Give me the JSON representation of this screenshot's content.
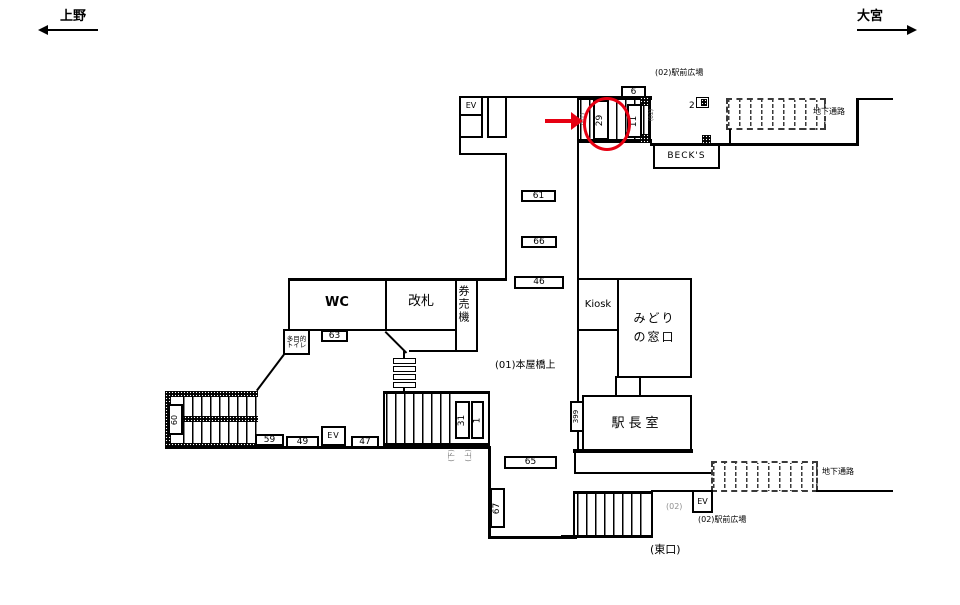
{
  "colors": {
    "line": "#000000",
    "highlight": "#e60012",
    "muted": "#8f8f8f"
  },
  "directions": {
    "left": "上野",
    "right": "大宮"
  },
  "rooms": {
    "ev": "EV",
    "wc": "WC",
    "kaisatsu": "改札",
    "kenbaiki": "券売機",
    "tamokuteki": [
      "多目的",
      "トイレ"
    ],
    "kiosk": "Kiosk",
    "midori": [
      "みどり",
      "の窓口"
    ],
    "ekicho": "駅長室",
    "becks": "BECK'S"
  },
  "labels": {
    "plaza_top": "(02)駅前広場",
    "plaza_bottom": "(02)駅前広場",
    "underpass_top": "地下通路",
    "underpass_bottom": "地下通路",
    "honyabashi": "(01)本屋橋上",
    "east_exit": "(東口)",
    "small_01": "(01)",
    "small_02_top": "(02)",
    "small_02_bottom": "(02)",
    "stair_down": "(下)",
    "stair_up": "(上)"
  },
  "numbers": {
    "n6": "6",
    "n2": "2",
    "n29": "29",
    "n11": "11",
    "n61": "61",
    "n66": "66",
    "n46": "46",
    "n63": "63",
    "n60": "60",
    "n59": "59",
    "n49": "49",
    "n47": "47",
    "n31": "31",
    "n1": "1",
    "n399": "399",
    "n65": "65",
    "n67": "67"
  }
}
